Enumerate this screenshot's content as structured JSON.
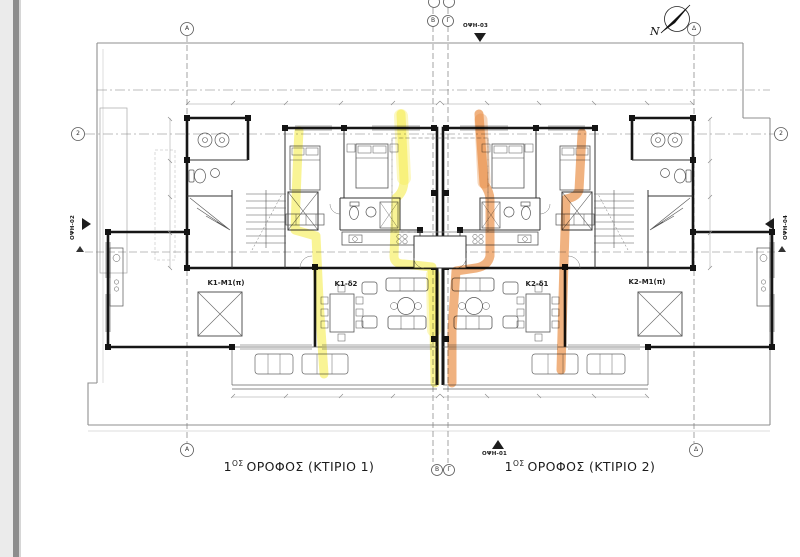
{
  "drawing": {
    "floor_titles": {
      "building1": {
        "num": "1",
        "sup": "ΟΣ",
        "rest": "ΟΡΟΦΟΣ  (ΚΤΙΡΙΟ 1)"
      },
      "building2": {
        "num": "1",
        "sup": "ΟΣ",
        "rest": "ΟΡΟΦΟΣ  (ΚΤΙΡΙΟ 2)"
      }
    },
    "unit_labels": {
      "k1_m1": "Κ1-Μ1(π)",
      "k1_d2": "Κ1-δ2",
      "k2_d1": "Κ2-δ1",
      "k2_m1": "Κ2-Μ1(π)"
    },
    "elevation_markers": {
      "bottom": "ΟΨΗ-01",
      "left": "ΟΨΗ-02",
      "top": "ΟΨΗ-03",
      "right": "ΟΨΗ-04"
    },
    "grid_bubbles": {
      "a": "Α",
      "b": "Β",
      "g": "Γ",
      "d": "Δ",
      "row2": "2"
    },
    "north_label": "N",
    "colors": {
      "highlight_yellow": "#f5ec4e",
      "highlight_orange": "#e8893c",
      "wall": "#161616",
      "site_line": "#8f8f8f"
    }
  }
}
